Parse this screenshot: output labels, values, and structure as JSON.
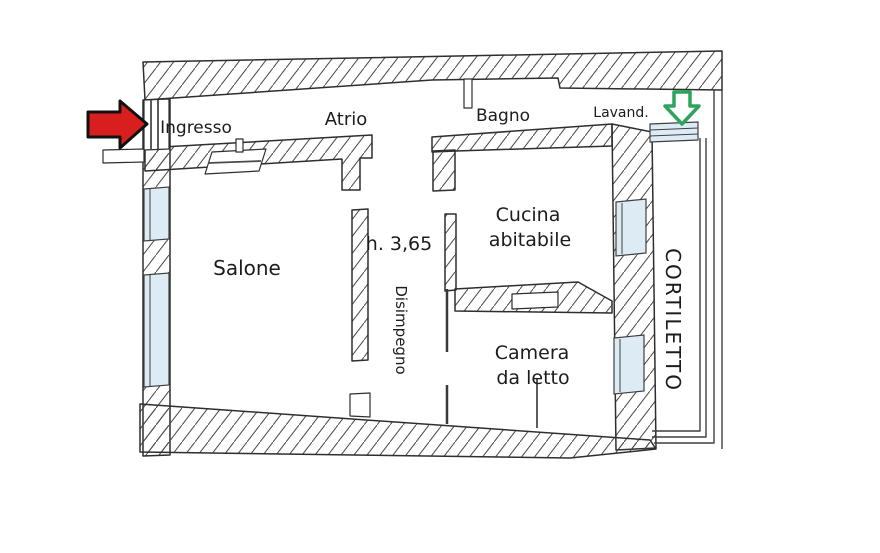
{
  "labels": {
    "ingresso": "Ingresso",
    "atrio": "Atrio",
    "bagno": "Bagno",
    "lavanderia": "Lavand.",
    "salone": "Salone",
    "disimpegno": "Disimpegno",
    "cucina_line1": "Cucina",
    "cucina_line2": "abitabile",
    "camera_line1": "Camera",
    "camera_line2": "da letto",
    "cortiletto": "CORTILETTO",
    "height_note": "h. 3,65"
  },
  "icons": {
    "entrance_arrow": "red-arrow-right-icon",
    "courtyard_exit_arrow": "green-arrow-down-icon"
  },
  "colors": {
    "wall_line": "#2e2e2e",
    "hatch_line": "#4a4a4a",
    "window_fill": "#ddecf4",
    "entrance_arrow": "#d81e1e",
    "exit_arrow": "#2fa35c",
    "text": "#1c1c1c",
    "background": "#ffffff"
  }
}
